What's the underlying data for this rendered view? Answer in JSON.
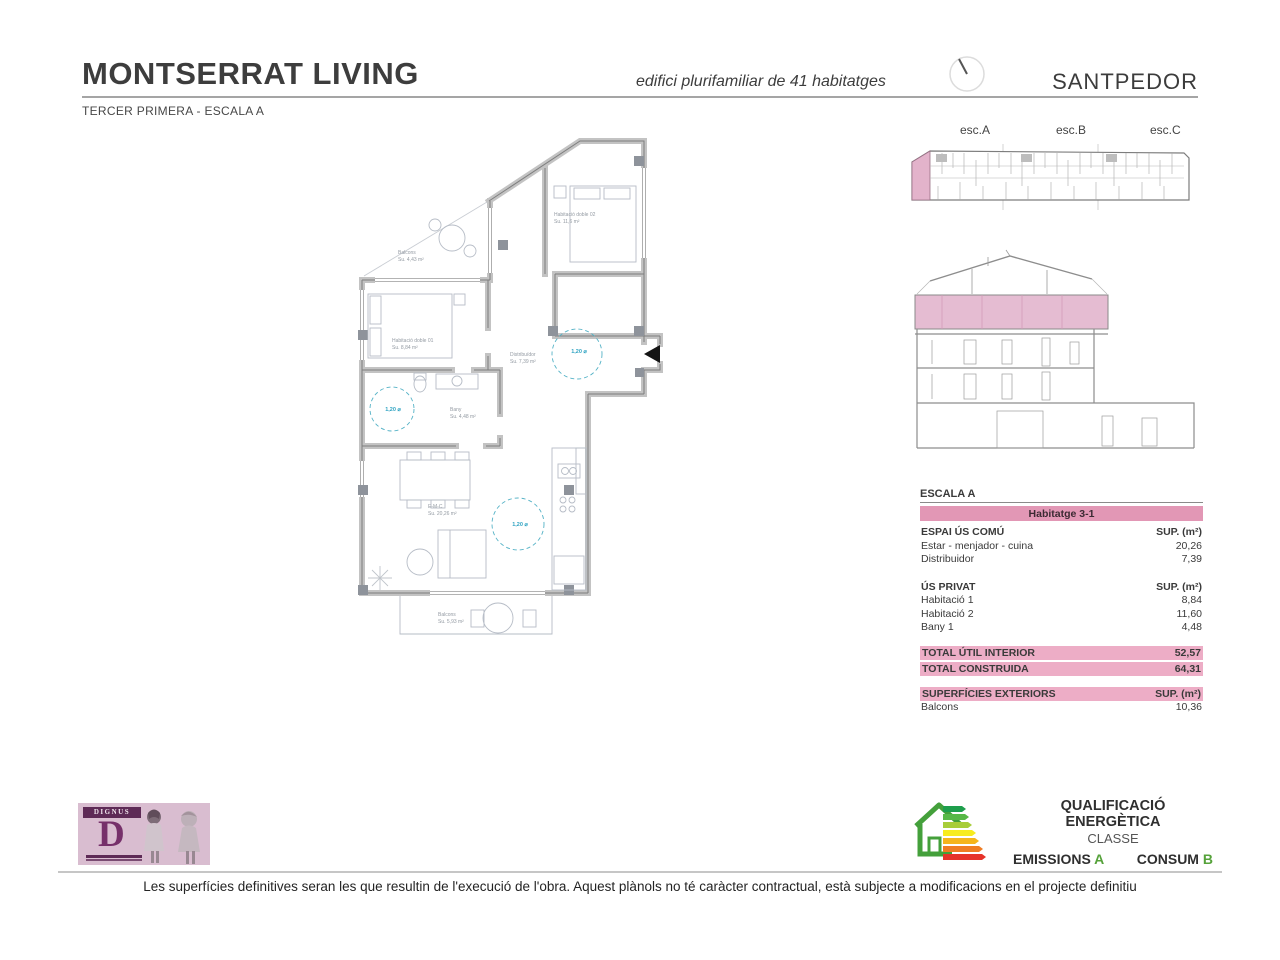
{
  "header": {
    "title": "MONTSERRAT LIVING",
    "subtitle": "TERCER PRIMERA - ESCALA A",
    "caption": "edifici plurifamiliar de 41 habitatges",
    "location": "SANTPEDOR"
  },
  "key_plan": {
    "esc_a": "esc.A",
    "esc_b": "esc.B",
    "esc_c": "esc.C"
  },
  "surface_table": {
    "title": "ESCALA A",
    "unit": "Habitatge 3-1",
    "sup": "SUP. (m²)",
    "comu": {
      "header": "ESPAI ÚS COMÚ",
      "rows": [
        {
          "label": "Estar - menjador - cuina",
          "value": "20,26"
        },
        {
          "label": "Distribuidor",
          "value": "7,39"
        }
      ]
    },
    "privat": {
      "header": "ÚS PRIVAT",
      "rows": [
        {
          "label": "Habitació 1",
          "value": "8,84"
        },
        {
          "label": "Habitació 2",
          "value": "11,60"
        },
        {
          "label": "Bany 1",
          "value": "4,48"
        }
      ]
    },
    "totals": [
      {
        "label": "TOTAL ÚTIL INTERIOR",
        "value": "52,57"
      },
      {
        "label": "TOTAL CONSTRUIDA",
        "value": "64,31"
      }
    ],
    "exteriors": {
      "header": "SUPERFÍCIES EXTERIORS",
      "rows": [
        {
          "label": "Balcons",
          "value": "10,36"
        }
      ]
    }
  },
  "energy": {
    "title": "QUALIFICACIÓ ENERGÈTICA",
    "subtitle": "CLASSE",
    "emissions_label": "EMISSIONS",
    "emissions_class": "A",
    "consum_label": "CONSUM",
    "consum_class": "B"
  },
  "logo": {
    "brand": "DIGNUS",
    "letter": "D"
  },
  "floor_plan": {
    "circle": "1,20 ⌀",
    "balcony_top": {
      "name": "Balcons",
      "area": "Su. 4,43 m²"
    },
    "bedroom2": {
      "name": "Habitació doble 02",
      "area": "Su. 11,6 m²"
    },
    "bedroom1": {
      "name": "Habitació doble 01",
      "area": "Su. 8,84 m²"
    },
    "hall": {
      "name": "Distribuïdor",
      "area": "Su. 7,39 m²"
    },
    "bath": {
      "name": "Bany",
      "area": "Su. 4,48 m²"
    },
    "living": {
      "name": "E-M-C",
      "area": "Su. 20,26 m²"
    },
    "balcony_bottom": {
      "name": "Balcons",
      "area": "Su. 5,93 m²"
    }
  },
  "footer": {
    "disclaimer": "Les superfícies definitives seran les que resultin de l'execució de l'obra. Aquest plànols no té caràcter contractual, està subjecte a modificacions en el projecte definitiu"
  },
  "colors": {
    "pink_banner": "#e297b5",
    "pink_light": "#edadc6",
    "highlight_pink": "#e5bcd2",
    "accent_green": "#55a23a",
    "cyan": "#3fa9c5"
  }
}
